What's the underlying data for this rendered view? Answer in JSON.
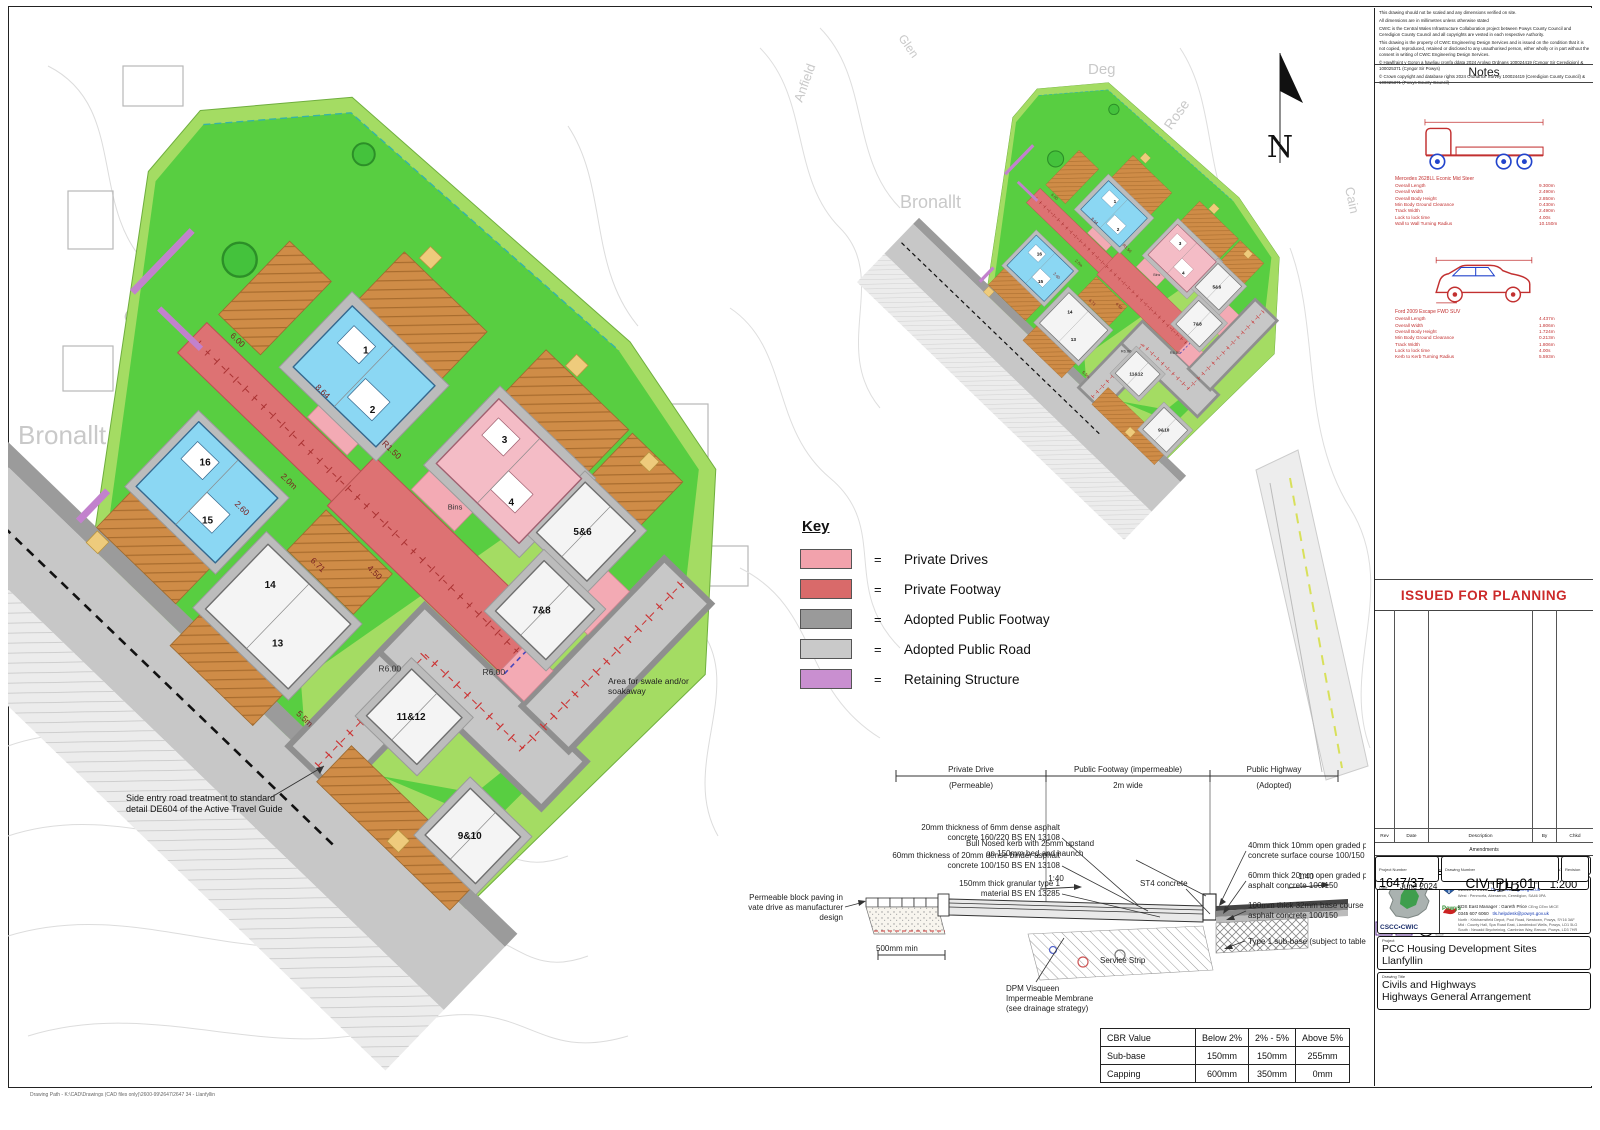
{
  "page": {
    "drawing_path": "Drawing Path - K:\\CAD\\Drawings (CAD files only)\\2600-99\\2647\\2647 34 - Llanfyllin"
  },
  "disclaimer": {
    "lines": [
      "This drawing should not be scaled and any dimensions verified on site.",
      "All dimensions are in millimetres unless otherwise stated",
      "CWIC is the Central Wales Infrastructure Collaboration project between Powys County Council and Ceredigion County Council and all copyrights are vested in each respective Authority.",
      "This drawing is the property of CWIC Engineering Design Services and is issued on the condition that it is not copied, reproduced, retained or disclosed to any unauthorised person, either wholly or in part without the consent in writing of CWIC Engineering Design Services.",
      "© Hawlfraint y Goron a hawliau cronfa ddata 2024 Arolwg Ordnans 100024419 (Cyngor Sir Ceredigion) & 100025371 (Cyngor Sir Powys)",
      "© Crown copyright and database rights 2024 Ordnance Survey 100024419 (Ceredigion County Council) & 100025371 (Powys County Council)"
    ]
  },
  "notes": {
    "title": "Notes",
    "vehicles": [
      {
        "name": "Mercedes 2628LL Econic Mid Steer",
        "specs": [
          {
            "label": "Overall Length",
            "value": "9.300m"
          },
          {
            "label": "Overall Width",
            "value": "2.490m"
          },
          {
            "label": "Overall Body Height",
            "value": "2.850m"
          },
          {
            "label": "Min Body Ground Clearance",
            "value": "0.430m"
          },
          {
            "label": "Track Width",
            "value": "2.490m"
          },
          {
            "label": "Lock to lock time",
            "value": "4.00s"
          },
          {
            "label": "Wall to Wall Turning Radius",
            "value": "10.150m"
          }
        ]
      },
      {
        "name": "Ford 2009 Escape FWD SUV",
        "specs": [
          {
            "label": "Overall Length",
            "value": "4.437m"
          },
          {
            "label": "Overall Width",
            "value": "1.806m"
          },
          {
            "label": "Overall Body Height",
            "value": "1.724m"
          },
          {
            "label": "Min Body Ground Clearance",
            "value": "0.213m"
          },
          {
            "label": "Track Width",
            "value": "1.806m"
          },
          {
            "label": "Lock to lock time",
            "value": "4.00s"
          },
          {
            "label": "Kerb to Kerb Turning Radius",
            "value": "5.593m"
          }
        ]
      }
    ]
  },
  "stamp": {
    "text": "ISSUED FOR PLANNING",
    "color": "#cc2a2a"
  },
  "amendments": {
    "label": "Amendments",
    "columns": [
      "Rev",
      "Date",
      "Description",
      "By",
      "Chkd"
    ]
  },
  "title_block": {
    "org": "Engineering Design Services",
    "logo_text": "CSCC•CWIC",
    "west_manager": "EDS West Manager : Steve Hallows",
    "west_quals": "CEng MICE",
    "west_phone": "01545 572513",
    "west_email": "hpw@ceredigion.gov.uk",
    "west_address": "West : Penmorfa, Aberaeron, Ceredigion, SA46 0PA",
    "powys": "Powys",
    "east_manager": "EDS East Manager : Gareth Price",
    "east_quals": "CEng CEnv MICE",
    "east_phone": "0345 607 6060",
    "east_email": "tls.helpdesk@powys.gov.uk",
    "east_address_north": "North : Kirkhamsfield Depot, Pool Road, Newtown, Powys, SY16 3AF",
    "east_address_mid": "Mid :   County Hall, Spa Road East, Llandrindod Wells, Powys, LD1 5LG",
    "east_address_south": "South : Neuadd Brycheiniog, Cambrian Way, Brecon, Powys, LD3 7HR",
    "project_label": "Project",
    "project_line1": "PCC Housing Development Sites",
    "project_line2": "Llanfyllin",
    "drawing_title_label": "Drawing Title",
    "title_line1": "Civils and Highways",
    "title_line2": "Highways General Arrangement",
    "by_label": "By",
    "by": "GW",
    "checked_label": "Checked",
    "checked": "DB",
    "approved_label": "Approved",
    "approved": "DB",
    "scale_label": "Scale at A1",
    "scale": "1:200",
    "date_label": "Date",
    "date": "June 2024",
    "project_number_label": "Project Number",
    "project_number": "1647/37",
    "drawing_number_label": "Drawing Number",
    "drawing_number": "CIV_PL_01",
    "revision_label": "Revision",
    "filename": "Drawing Filename : - C3D - EG Model C bound.dwg",
    "last_saved": "Last saved : -    02/08/2024"
  },
  "key": {
    "title": "Key",
    "eq": "=",
    "items": [
      {
        "label": "Private Drives",
        "color": "#f2a2ac"
      },
      {
        "label": "Private Footway",
        "color": "#d96a6a"
      },
      {
        "label": "Adopted Public Footway",
        "color": "#9a9a9a"
      },
      {
        "label": "Adopted Public Road",
        "color": "#c9c9c9"
      },
      {
        "label": "Retaining Structure",
        "color": "#c98fd0"
      }
    ]
  },
  "section": {
    "span1a": "Private Drive",
    "span1b": "(Permeable)",
    "span2a": "Public Footway (impermeable)",
    "span2b": "2m wide",
    "span3a": "Public Highway",
    "span3b": "(Adopted)",
    "l1a": "20mm thickness of 6mm dense asphalt",
    "l1b": "concrete 160/220 BS EN 13108",
    "l2a": "60mm thickness of 20mm dense binder asphalt",
    "l2b": "concrete 100/150 BS EN 13108",
    "l3a": "150mm thick granular type 1",
    "l3b": "material  BS EN 13285",
    "l4a": "Permeable block paving in",
    "l4b": "private drive as manufacturer",
    "l4c": "design",
    "l5a": "Bull Nosed kerb with 25mm upstand",
    "l5b": "on 150mm bed and haunch",
    "l6": "ST4 concrete",
    "slope1": "1:40",
    "slope2": "1:40",
    "dim500": "500mm min",
    "service_strip": "Service Strip",
    "r1a": "40mm thick 10mm open graded permeable asphalt",
    "r1b": "concrete surface course 100/150",
    "r2a": "60mm thick 20mm open graded porous binder course",
    "r2b": "asphalt concrete 100/150",
    "r3a": "100mm thick 32mm base course",
    "r3b": "asphalt concrete 100/150",
    "r4": "Type 1 sub-base (subject to table below)",
    "dpm1": "DPM Visqueen",
    "dpm2": "Impermeable Membrane",
    "dpm3": "(see drainage strategy)"
  },
  "cbr_table": {
    "headers": [
      "CBR Value",
      "Below 2%",
      "2% - 5%",
      "Above 5%"
    ],
    "rows": [
      [
        "Sub-base",
        "150mm",
        "150mm",
        "255mm"
      ],
      [
        "Capping",
        "600mm",
        "350mm",
        "0mm"
      ]
    ]
  },
  "north": {
    "label": "N"
  },
  "main_plan": {
    "street_labels": [
      "Bronallt",
      "Cymerau",
      "Deg",
      "Briar"
    ],
    "plots": [
      "1",
      "2",
      "3",
      "4",
      "5&6",
      "7&8",
      "9&10",
      "11&12",
      "13",
      "14",
      "15",
      "16"
    ],
    "dims": [
      "6.00",
      "8.64",
      "R1.50",
      "4.50",
      "2.0m",
      "6.71",
      "5.5m",
      "2.60",
      "R6.00",
      "R6.00"
    ],
    "bins_label": "Bins",
    "swale_note_1": "Area for swale and/or",
    "swale_note_2": "soakaway",
    "side_entry_note_1": "Side entry road treatment to standard",
    "side_entry_note_2": "detail DE604 of the Active Travel Guide"
  },
  "overview_plan": {
    "street_labels": [
      "Anfield",
      "Glen",
      "Briar Rose",
      "Cain",
      "Bronallt",
      "Deg"
    ]
  }
}
